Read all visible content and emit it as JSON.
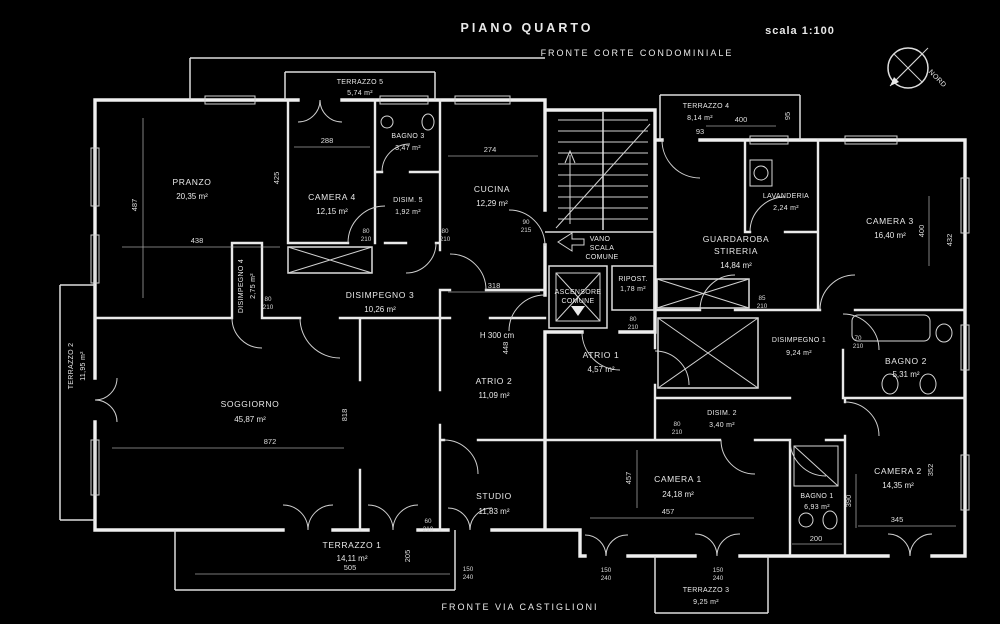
{
  "header": {
    "title": "PIANO QUARTO",
    "scale_label": "scala 1:100",
    "front_top": "FRONTE CORTE CONDOMINIALE",
    "front_bottom": "FRONTE VIA CASTIGLIONI",
    "compass_label": "NORD",
    "height_note": "H 300 cm"
  },
  "rooms": [
    {
      "name": "PRANZO",
      "area": "20,35 m²"
    },
    {
      "name": "CAMERA 4",
      "area": "12,15 m²"
    },
    {
      "name": "BAGNO 3",
      "area": "3,47 m²"
    },
    {
      "name": "DISIM. 5",
      "area": "1,92 m²"
    },
    {
      "name": "CUCINA",
      "area": "12,29 m²"
    },
    {
      "name": "TERRAZZO 5",
      "area": "5,74 m²"
    },
    {
      "name": "TERRAZZO 4",
      "area": "8,14 m²"
    },
    {
      "name": "VANO",
      "name2": "SCALA",
      "name3": "COMUNE"
    },
    {
      "name": "ASCENSORE",
      "name2": "COMUNE"
    },
    {
      "name": "RIPOST.",
      "area": "1,78 m²"
    },
    {
      "name": "LAVANDERIA",
      "area": "2,24 m²"
    },
    {
      "name": "GUARDAROBA",
      "name2": "STIRERIA",
      "area": "14,84 m²"
    },
    {
      "name": "CAMERA 3",
      "area": "16,40 m²"
    },
    {
      "name": "DISIMPEGNO 3",
      "area": "10,26 m²"
    },
    {
      "name": "DISIMPEGNO 4",
      "area": "2,75 m²"
    },
    {
      "name": "TERRAZZO 2",
      "area": "11,95 m²"
    },
    {
      "name": "ATRIO 2",
      "area": "11,09 m²"
    },
    {
      "name": "ATRIO 1",
      "area": "4,57 m²"
    },
    {
      "name": "DISIMPEGNO 1",
      "area": "9,24 m²"
    },
    {
      "name": "DISIM. 2",
      "area": "3,40 m²"
    },
    {
      "name": "BAGNO 2",
      "area": "5,31 m²"
    },
    {
      "name": "SOGGIORNO",
      "area": "45,87 m²"
    },
    {
      "name": "STUDIO",
      "area": "11,83 m²"
    },
    {
      "name": "CAMERA 1",
      "area": "24,18 m²"
    },
    {
      "name": "BAGNO 1",
      "area": "6,93 m²"
    },
    {
      "name": "CAMERA 2",
      "area": "14,35 m²"
    },
    {
      "name": "TERRAZZO 1",
      "area": "14,11 m²"
    },
    {
      "name": "TERRAZZO 3",
      "area": "9,25 m²"
    }
  ],
  "dims": [
    "487",
    "438",
    "425",
    "288",
    "274",
    "318",
    "448",
    "818",
    "872",
    "505",
    "205",
    "457",
    "457",
    "200",
    "390",
    "345",
    "352",
    "400",
    "432",
    "400",
    "95",
    "93"
  ],
  "door_labels": [
    {
      "w": "80",
      "h": "210"
    },
    {
      "w": "80",
      "h": "210"
    },
    {
      "w": "80",
      "h": "210"
    },
    {
      "w": "90",
      "h": "215"
    },
    {
      "w": "80",
      "h": "210"
    },
    {
      "w": "85",
      "h": "210"
    },
    {
      "w": "70",
      "h": "210"
    },
    {
      "w": "60",
      "h": "210"
    },
    {
      "w": "150",
      "h": "240"
    },
    {
      "w": "150",
      "h": "240"
    },
    {
      "w": "150",
      "h": "240"
    },
    {
      "w": "80",
      "h": "210"
    }
  ]
}
